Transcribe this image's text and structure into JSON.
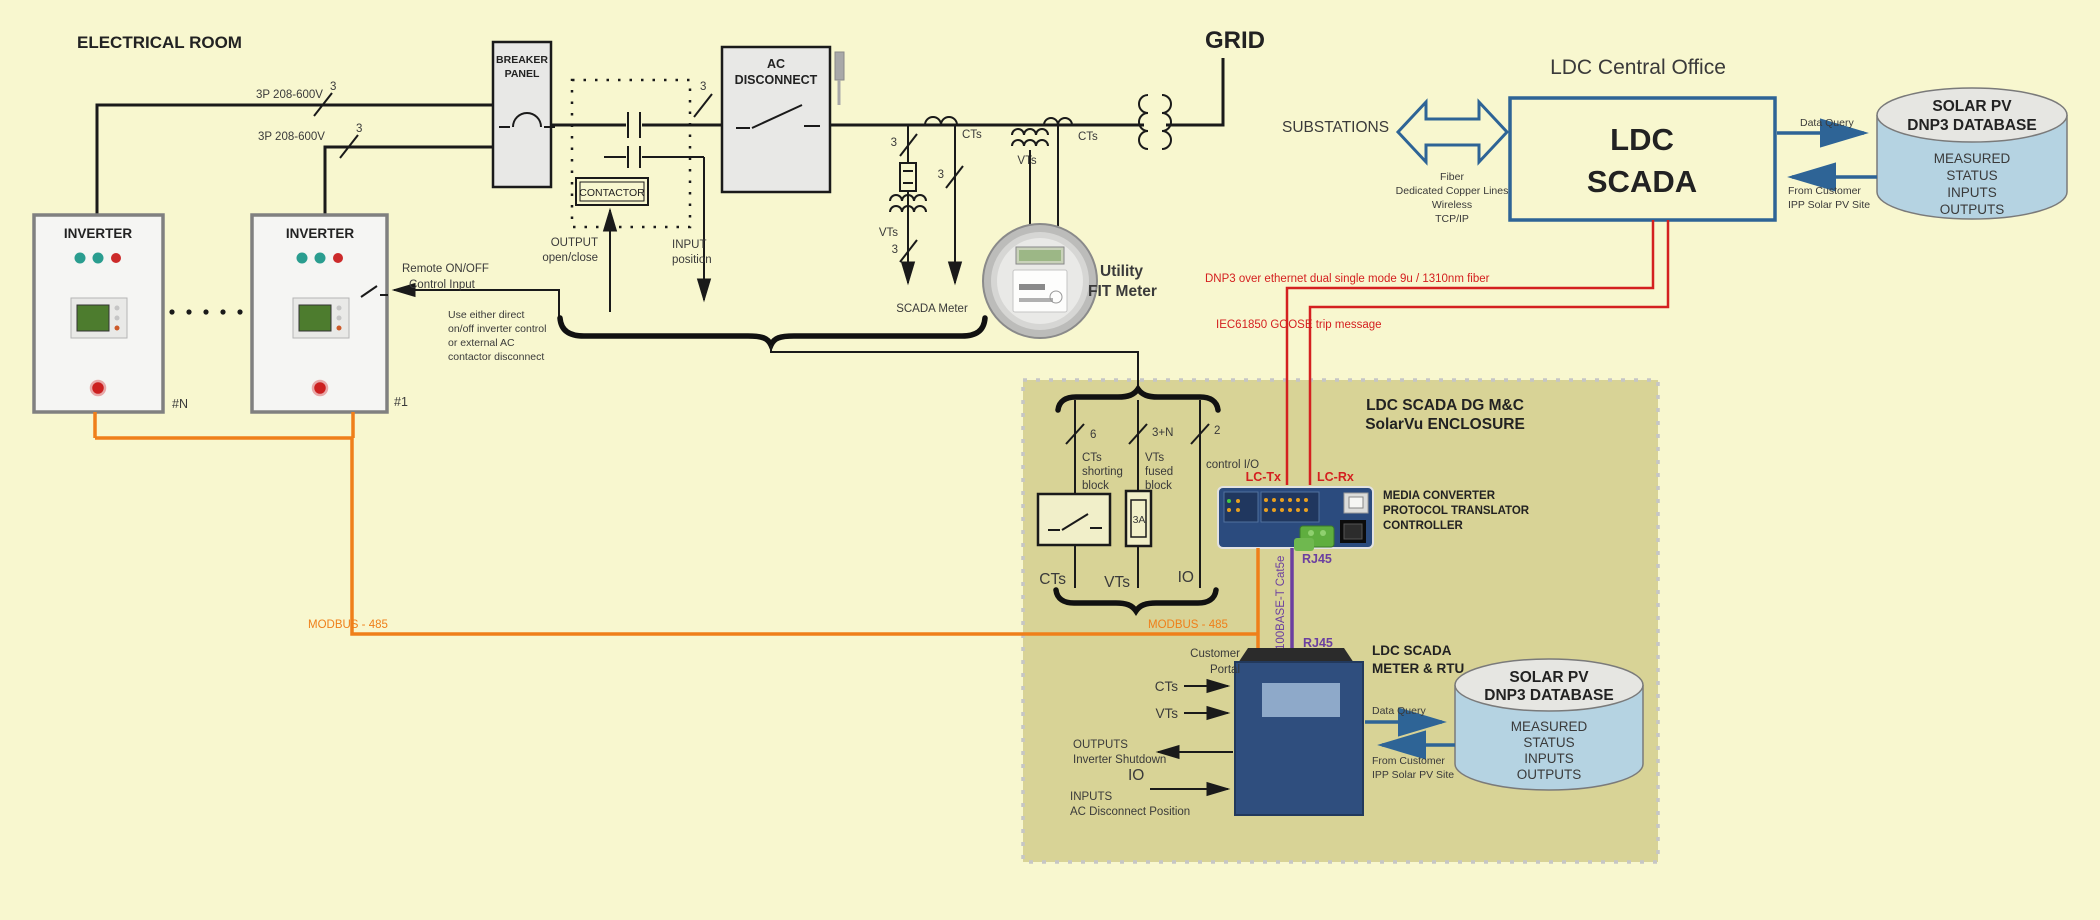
{
  "electrical_room": {
    "title": "ELECTRICAL ROOM",
    "bus1": {
      "label": "3P 208-600V",
      "count": "3"
    },
    "bus2": {
      "label": "3P 208-600V",
      "count": "3"
    },
    "breaker": {
      "l1": "BREAKER",
      "l2": "PANEL"
    },
    "contactor": "CONTACTOR",
    "output": {
      "l1": "OUTPUT",
      "l2": "open/close"
    },
    "input": {
      "l1": "INPUT",
      "l2": "position"
    },
    "acdisc": {
      "l1": "AC",
      "l2": "DISCONNECT",
      "count": "3"
    },
    "inverter_label": "INVERTER",
    "unit_last": "#N",
    "unit_first": "#1",
    "remote": {
      "l1": "Remote ON/OFF",
      "l2": "Control Input"
    },
    "note": [
      "Use either direct",
      "on/off inverter control",
      "or external AC",
      "contactor disconnect"
    ],
    "modbus_left": "MODBUS - 485"
  },
  "metering": {
    "vt_branch": {
      "label": "VTs",
      "count_top": "3",
      "count_bottom": "3"
    },
    "ct_branch": {
      "label": "CTs",
      "count": "3"
    },
    "scada_meter": "SCADA Meter",
    "meter_vts": "VTs",
    "meter_cts": "CTs",
    "utility": {
      "l1": "Utility",
      "l2": "FIT Meter"
    },
    "grid": "GRID"
  },
  "office": {
    "title": "LDC Central Office",
    "substations": "SUBSTATIONS",
    "links": [
      "Fiber",
      "Dedicated Copper Lines",
      "Wireless",
      "TCP/IP"
    ],
    "scada": {
      "l1": "LDC",
      "l2": "SCADA"
    },
    "data_query": "Data Query",
    "from_customer": {
      "l1": "From Customer",
      "l2": "IPP Solar PV Site"
    },
    "db": {
      "title1": "SOLAR PV",
      "title2": "DNP3 DATABASE",
      "rows": [
        "MEASURED",
        "STATUS",
        "INPUTS",
        "OUTPUTS"
      ]
    }
  },
  "fiber": {
    "dnp3": "DNP3 over ethernet dual single mode 9u / 1310nm  fiber",
    "goose": "IEC61850 GOOSE trip message",
    "lc_tx": "LC-Tx",
    "lc_rx": "LC-Rx"
  },
  "enclosure": {
    "title": {
      "l1": "LDC SCADA DG M&C",
      "l2": "SolarVu ENCLOSURE"
    },
    "ct": {
      "count": "6",
      "label": [
        "CTs",
        "shorting",
        "block"
      ],
      "bus": "CTs"
    },
    "vt": {
      "count": "3+N",
      "label": [
        "VTs",
        "fused",
        "block"
      ],
      "fuse": "3A",
      "bus": "VTs"
    },
    "io": {
      "count": "2",
      "label": "control I/O",
      "bus": "IO"
    },
    "media": [
      "MEDIA CONVERTER",
      "PROTOCOL TRANSLATOR",
      "CONTROLLER"
    ],
    "rj45_top": "RJ45",
    "cat5e": "100BASE-T  Cat5e",
    "rj45_bottom": "RJ45",
    "modbus_right": "MODBUS - 485",
    "customer": {
      "l1": "Customer",
      "l2": "Portal"
    },
    "rtu": {
      "l1": "LDC SCADA",
      "l2": "METER & RTU"
    },
    "sig_cts": "CTs",
    "sig_vts": "VTs",
    "outputs": {
      "l1": "OUTPUTS",
      "l2": "Inverter Shutdown"
    },
    "sig_io": "IO",
    "inputs": {
      "l1": "INPUTS",
      "l2": "AC Disconnect Position"
    },
    "data_query": "Data Query",
    "from_customer": {
      "l1": "From Customer",
      "l2": "IPP Solar PV Site"
    },
    "db": {
      "title1": "SOLAR PV",
      "title2": "DNP3 DATABASE",
      "rows": [
        "MEASURED",
        "STATUS",
        "INPUTS",
        "OUTPUTS"
      ]
    }
  },
  "colors": {
    "background": "#f8f7cf",
    "enclosure": "#d8d396",
    "accent_blue": "#2e6496",
    "accent_red": "#d42020",
    "accent_orange": "#ef7f1a",
    "accent_purple": "#6b3fa0",
    "cylinder": "#b5d3e2"
  }
}
